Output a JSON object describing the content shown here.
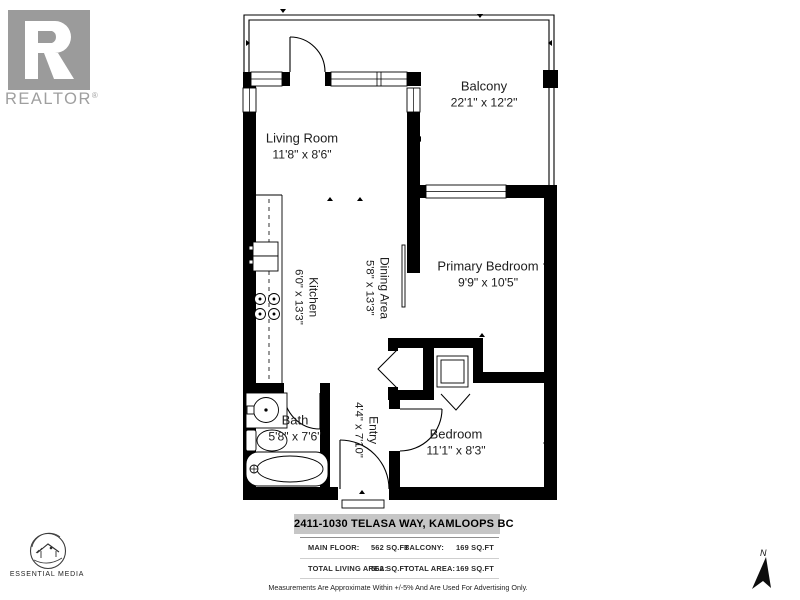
{
  "branding": {
    "realtor_word": "REALTOR",
    "reg_mark": "®",
    "essential_media_label": "ESSENTIAL MEDIA"
  },
  "compass": {
    "north_label": "N"
  },
  "rooms": {
    "balcony": {
      "name": "Balcony",
      "dims": "22'1\" x 12'2\""
    },
    "living_room": {
      "name": "Living Room",
      "dims": "11'8\" x 8'6\""
    },
    "kitchen": {
      "name": "Kitchen",
      "dims": "6'0\" x 13'3\""
    },
    "dining_area": {
      "name": "Dining Area",
      "dims": "5'8\" x 13'3\""
    },
    "primary_bedroom": {
      "name": "Primary Bedroom",
      "dims": "9'9\" x 10'5\""
    },
    "bath": {
      "name": "Bath",
      "dims": "5'8\" x 7'6\""
    },
    "entry": {
      "name": "Entry",
      "dims": "4'4\" x 7'10\""
    },
    "bedroom": {
      "name": "Bedroom",
      "dims": "11'1\" x 8'3\""
    }
  },
  "footer": {
    "address": "2411-1030 TELASA WAY, KAMLOOPS BC",
    "area_rows": [
      {
        "c0": "MAIN FLOOR:",
        "c1": "562 SQ.FT",
        "c2": "BALCONY:",
        "c3": "169 SQ.FT"
      },
      {
        "c0": "TOTAL LIVING AREA:",
        "c1": "562 SQ.FT",
        "c2": "TOTAL AREA:",
        "c3": "169 SQ.FT"
      }
    ],
    "disclaimer": "Measurements Are Approximate Within +/-5% And Are Used For Advertising Only."
  },
  "colors": {
    "wall": "#000000",
    "logo_gray": "#9b9b9b",
    "address_bar_bg": "#c6c6c6"
  }
}
